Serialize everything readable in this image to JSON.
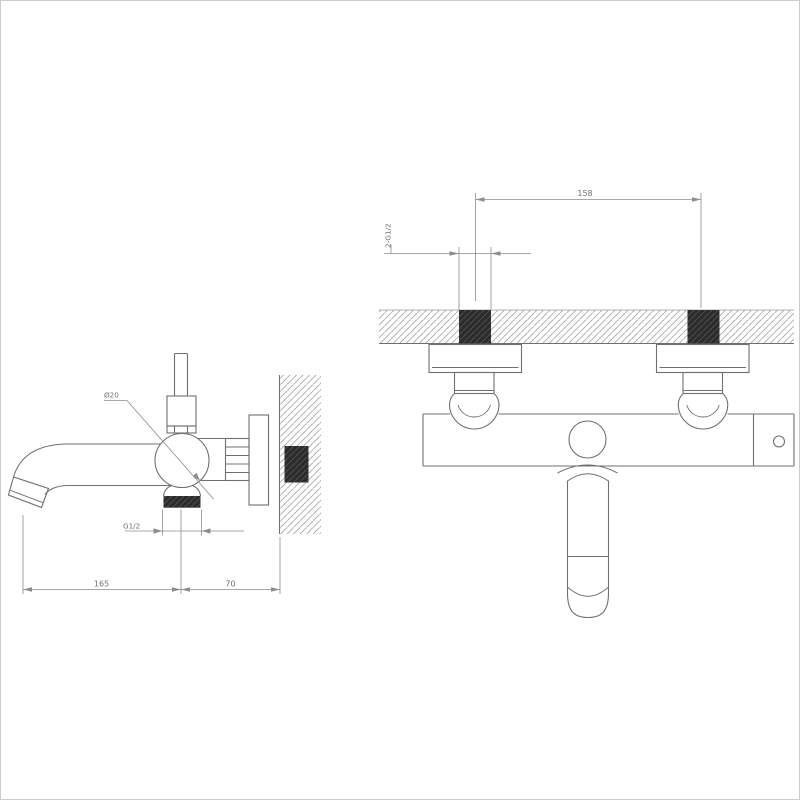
{
  "drawing": {
    "kind": "bath-shower mixer installation drawing",
    "side_view": {
      "spout_diameter": "Ø20",
      "outlet_thread": "G1/2",
      "dim_reach": "165",
      "dim_wall_offset": "70"
    },
    "front_view": {
      "dim_width": "158",
      "supply_thread": "2-G1/2"
    },
    "colors": {
      "line": "#707070",
      "dim_line": "#8c8c8c",
      "hatch": "#a8a8a8",
      "dark_fill": "#2b2b2b",
      "page_border": "#cccccc",
      "background": "#ffffff"
    }
  }
}
